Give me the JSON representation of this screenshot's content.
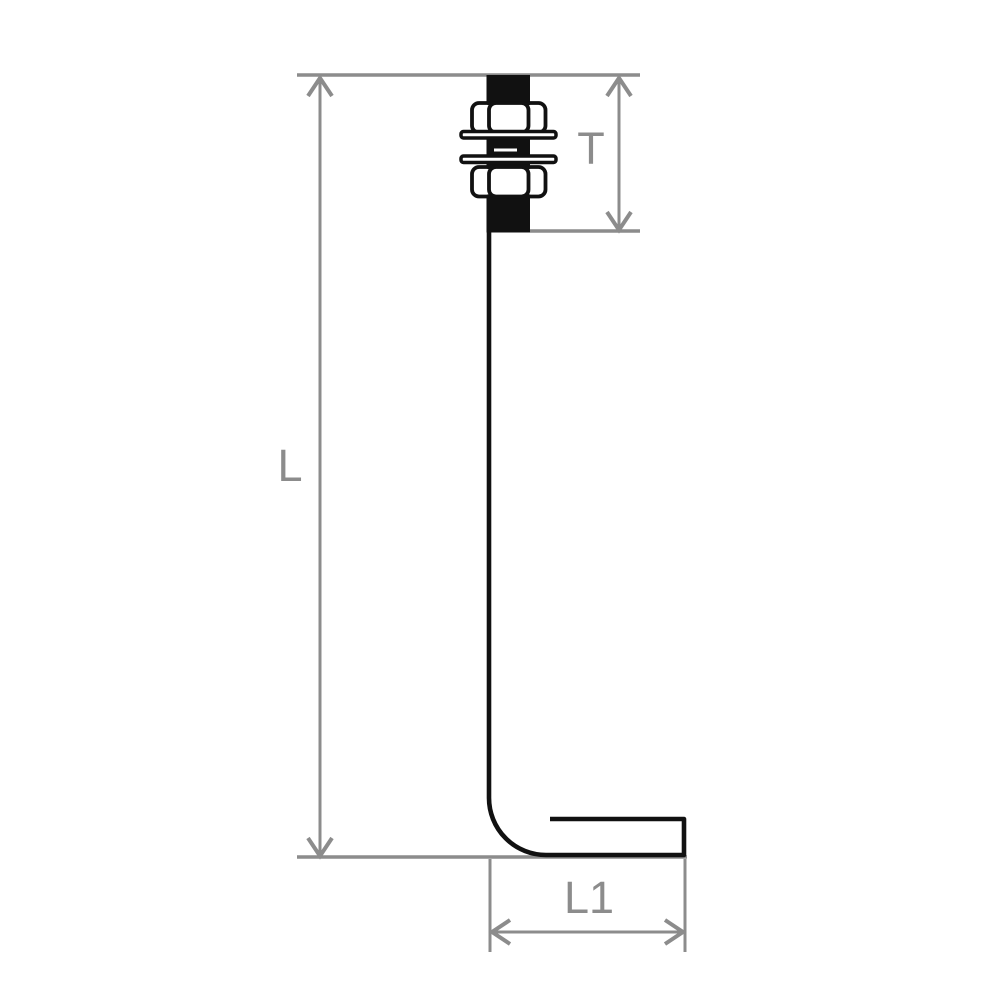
{
  "diagram": {
    "type": "technical-drawing",
    "subject": "L-shaped anchor bolt (bent foundation bolt) with two hex nuts and two washers",
    "labels": {
      "overall_length": "L",
      "thread_length": "T",
      "bent_leg_length": "L1"
    },
    "colors": {
      "background": "#ffffff",
      "part_stroke": "#111111",
      "part_fill": "#ffffff",
      "thread_fill": "#111111",
      "dimension": "#8c8c8c"
    }
  }
}
